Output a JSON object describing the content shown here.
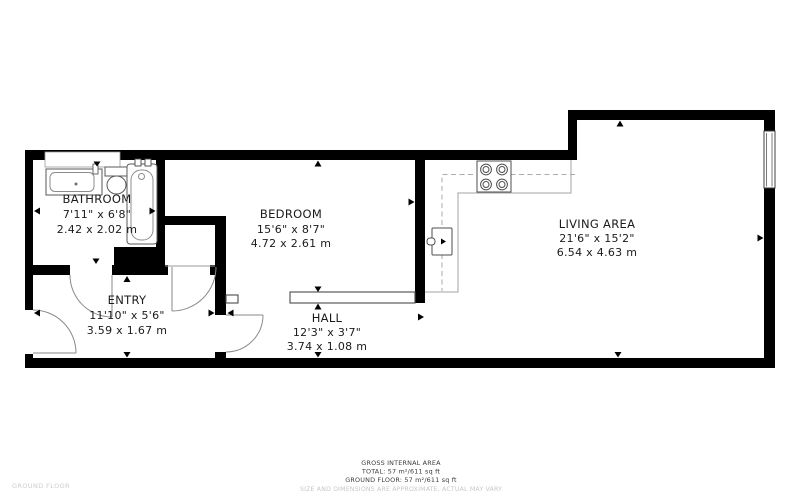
{
  "plan_title": "GROUND FLOOR",
  "rooms": {
    "bathroom": {
      "name": "BATHROOM",
      "imperial": "7'11\" x 6'8\"",
      "metric": "2.42 x 2.02 m"
    },
    "entry": {
      "name": "ENTRY",
      "imperial": "11'10\" x 5'6\"",
      "metric": "3.59 x 1.67 m"
    },
    "bedroom": {
      "name": "BEDROOM",
      "imperial": "15'6\" x 8'7\"",
      "metric": "4.72 x 2.61 m"
    },
    "hall": {
      "name": "HALL",
      "imperial": "12'3\" x 3'7\"",
      "metric": "3.74 x 1.08 m"
    },
    "living": {
      "name": "LIVING AREA",
      "imperial": "21'6\" x 15'2\"",
      "metric": "6.54 x 4.63 m"
    }
  },
  "footer": {
    "gross_area_label": "GROSS INTERNAL AREA",
    "total": "TOTAL: 57 m²/611 sq ft",
    "ground_floor": "GROUND FLOOR: 57 m²/611 sq ft",
    "disclaimer": "SIZE AND DIMENSIONS ARE APPROXIMATE, ACTUAL MAY VARY"
  },
  "colors": {
    "wall": "#000000",
    "fixture_stroke": "#5a5a5a",
    "counter_stroke": "#a3a3a3",
    "text": "#1b1b1b",
    "muted_text": "#c7c7c7"
  }
}
